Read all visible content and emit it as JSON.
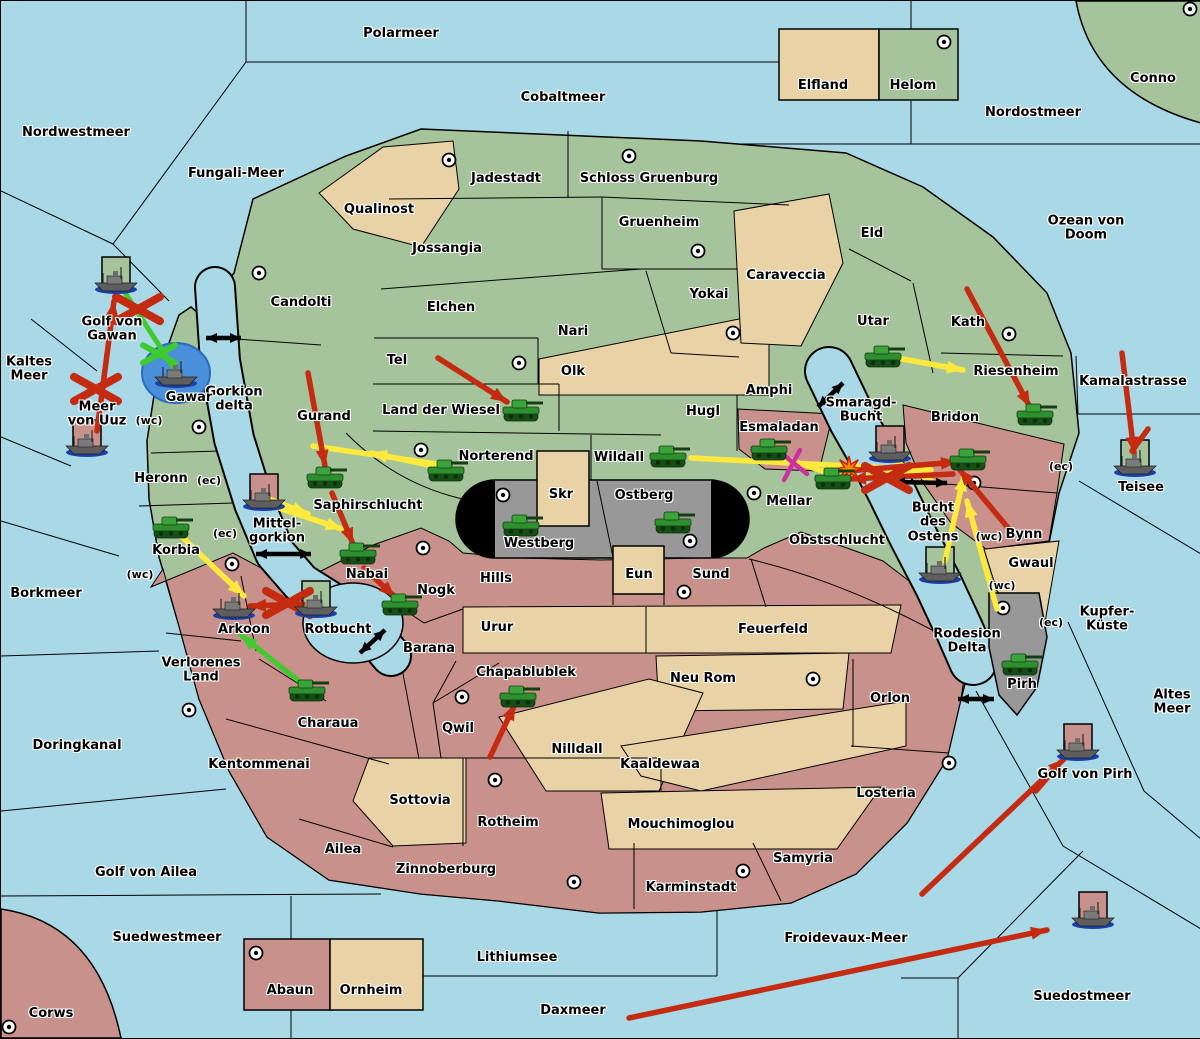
{
  "map": {
    "title": "Diplomacy variant strategy map",
    "width": 1200,
    "height": 1037,
    "colors": {
      "sea": "#A9D8E6",
      "land_green": "#A5C49B",
      "land_tan": "#E9D2A5",
      "land_pink": "#C9918B",
      "mountain_gray": "#989898",
      "tunnel_black": "#000000",
      "attack_red": "#C42B10",
      "support_yellow": "#FFE93C",
      "support_green": "#3ECB2E",
      "cut_magenta": "#CC2F9F",
      "strait_black": "#000000",
      "convoy_blue": "#4A8FD9",
      "unit_green": "#2E8F2E"
    },
    "sea_regions": [
      {
        "label": "Polarmeer",
        "x": 400,
        "y": 33
      },
      {
        "label": "Nordwestmeer",
        "x": 75,
        "y": 132
      },
      {
        "label": "Fungali-Meer",
        "x": 235,
        "y": 173
      },
      {
        "label": "Cobaltmeer",
        "x": 562,
        "y": 97
      },
      {
        "label": "Nordostmeer",
        "x": 1032,
        "y": 112
      },
      {
        "label": "Ozean von Doom",
        "x": 1085,
        "y": 228
      },
      {
        "label": "Kaltes\nMeer",
        "x": 28,
        "y": 369
      },
      {
        "label": "Golf von\nGawan",
        "x": 111,
        "y": 329
      },
      {
        "label": "Meer\nvon Uuz",
        "x": 96,
        "y": 414
      },
      {
        "label": "Gorkion\ndelta",
        "x": 233,
        "y": 399
      },
      {
        "label": "Mittel-\ngorkion",
        "x": 276,
        "y": 531
      },
      {
        "label": "Borkmeer",
        "x": 45,
        "y": 593
      },
      {
        "label": "Doringkanal",
        "x": 76,
        "y": 745
      },
      {
        "label": "Golf von Ailea",
        "x": 145,
        "y": 872
      },
      {
        "label": "Suedwestmeer",
        "x": 166,
        "y": 937
      },
      {
        "label": "Lithiumsee",
        "x": 516,
        "y": 957
      },
      {
        "label": "Daxmeer",
        "x": 572,
        "y": 1010
      },
      {
        "label": "Froidevaux-Meer",
        "x": 845,
        "y": 938
      },
      {
        "label": "Suedostmeer",
        "x": 1081,
        "y": 996
      },
      {
        "label": "Kamalastrasse",
        "x": 1132,
        "y": 381
      },
      {
        "label": "Teisee",
        "x": 1140,
        "y": 487
      },
      {
        "label": "Smaragd-\nBucht",
        "x": 860,
        "y": 410
      },
      {
        "label": "Bucht\ndes\nOstens",
        "x": 932,
        "y": 522
      },
      {
        "label": "Rotbucht",
        "x": 337,
        "y": 629
      },
      {
        "label": "Altes\nMeer",
        "x": 1171,
        "y": 702
      },
      {
        "label": "Kupfer-\nKüste",
        "x": 1106,
        "y": 619
      },
      {
        "label": "Golf von Pirh",
        "x": 1084,
        "y": 774
      },
      {
        "label": "Rodesion\nDelta",
        "x": 966,
        "y": 641
      }
    ],
    "land_regions": [
      {
        "label": "Conno",
        "x": 1152,
        "y": 78
      },
      {
        "label": "Corws",
        "x": 50,
        "y": 1013
      },
      {
        "label": "Elfland",
        "x": 822,
        "y": 85
      },
      {
        "label": "Helom",
        "x": 912,
        "y": 85
      },
      {
        "label": "Qualinost",
        "x": 378,
        "y": 209
      },
      {
        "label": "Jadestadt",
        "x": 505,
        "y": 178
      },
      {
        "label": "Schloss Gruenburg",
        "x": 648,
        "y": 178
      },
      {
        "label": "Gruenheim",
        "x": 658,
        "y": 222
      },
      {
        "label": "Jossangia",
        "x": 446,
        "y": 248
      },
      {
        "label": "Candolti",
        "x": 300,
        "y": 302
      },
      {
        "label": "Elchen",
        "x": 450,
        "y": 307
      },
      {
        "label": "Nari",
        "x": 572,
        "y": 331
      },
      {
        "label": "Olk",
        "x": 572,
        "y": 371
      },
      {
        "label": "Tel",
        "x": 396,
        "y": 360
      },
      {
        "label": "Land der Wiesel",
        "x": 440,
        "y": 410
      },
      {
        "label": "Gurand",
        "x": 323,
        "y": 416
      },
      {
        "label": "Norterend",
        "x": 495,
        "y": 456
      },
      {
        "label": "Saphirschlucht",
        "x": 367,
        "y": 505
      },
      {
        "label": "Yokai",
        "x": 708,
        "y": 294
      },
      {
        "label": "Caraveccia",
        "x": 785,
        "y": 275
      },
      {
        "label": "Eld",
        "x": 871,
        "y": 233
      },
      {
        "label": "Utar",
        "x": 872,
        "y": 321
      },
      {
        "label": "Kath",
        "x": 967,
        "y": 322
      },
      {
        "label": "Riesenheim",
        "x": 1015,
        "y": 371
      },
      {
        "label": "Hugl",
        "x": 702,
        "y": 411
      },
      {
        "label": "Amphi",
        "x": 768,
        "y": 390
      },
      {
        "label": "Esmaladan",
        "x": 778,
        "y": 427
      },
      {
        "label": "Wildall",
        "x": 618,
        "y": 457
      },
      {
        "label": "Mellar",
        "x": 788,
        "y": 501
      },
      {
        "label": "Obstschlucht",
        "x": 836,
        "y": 540
      },
      {
        "label": "Bridon",
        "x": 954,
        "y": 417
      },
      {
        "label": "Bynn",
        "x": 1023,
        "y": 534
      },
      {
        "label": "Gwaul",
        "x": 1030,
        "y": 563
      },
      {
        "label": "Pirh",
        "x": 1021,
        "y": 684
      },
      {
        "label": "Heronn",
        "x": 160,
        "y": 478
      },
      {
        "label": "Korbia",
        "x": 175,
        "y": 550
      },
      {
        "label": "Gawar",
        "x": 188,
        "y": 397
      },
      {
        "label": "Skr",
        "x": 560,
        "y": 494
      },
      {
        "label": "Ostberg",
        "x": 643,
        "y": 495
      },
      {
        "label": "Westberg",
        "x": 538,
        "y": 543
      },
      {
        "label": "Eun",
        "x": 638,
        "y": 574
      },
      {
        "label": "Hills",
        "x": 495,
        "y": 578
      },
      {
        "label": "Sund",
        "x": 710,
        "y": 574
      },
      {
        "label": "Urur",
        "x": 496,
        "y": 627
      },
      {
        "label": "Feuerfeld",
        "x": 772,
        "y": 629
      },
      {
        "label": "Barana",
        "x": 428,
        "y": 648
      },
      {
        "label": "Nogk",
        "x": 435,
        "y": 590
      },
      {
        "label": "Nabai",
        "x": 366,
        "y": 574
      },
      {
        "label": "Arkoon",
        "x": 243,
        "y": 629
      },
      {
        "label": "Verlorenes\nLand",
        "x": 200,
        "y": 670
      },
      {
        "label": "Charaua",
        "x": 327,
        "y": 723
      },
      {
        "label": "Kentommenai",
        "x": 258,
        "y": 764
      },
      {
        "label": "Chapablublek",
        "x": 525,
        "y": 672
      },
      {
        "label": "Qwil",
        "x": 457,
        "y": 728
      },
      {
        "label": "Nilldall",
        "x": 576,
        "y": 749
      },
      {
        "label": "Neu Rom",
        "x": 702,
        "y": 678
      },
      {
        "label": "Kaaldewaa",
        "x": 659,
        "y": 764
      },
      {
        "label": "Sottovia",
        "x": 419,
        "y": 800
      },
      {
        "label": "Rotheim",
        "x": 507,
        "y": 822
      },
      {
        "label": "Mouchimoglou",
        "x": 680,
        "y": 824
      },
      {
        "label": "Zinnoberburg",
        "x": 445,
        "y": 869
      },
      {
        "label": "Karminstadt",
        "x": 690,
        "y": 887
      },
      {
        "label": "Samyria",
        "x": 802,
        "y": 858
      },
      {
        "label": "Losteria",
        "x": 885,
        "y": 793
      },
      {
        "label": "Orlon",
        "x": 889,
        "y": 698
      },
      {
        "label": "Ailea",
        "x": 342,
        "y": 849
      },
      {
        "label": "Abaun",
        "x": 289,
        "y": 990
      },
      {
        "label": "Ornheim",
        "x": 370,
        "y": 990
      }
    ],
    "coast_labels": [
      {
        "text": "(wc)",
        "x": 148,
        "y": 420
      },
      {
        "text": "(ec)",
        "x": 208,
        "y": 480
      },
      {
        "text": "(ec)",
        "x": 224,
        "y": 533
      },
      {
        "text": "(wc)",
        "x": 139,
        "y": 574
      },
      {
        "text": "(wc)",
        "x": 988,
        "y": 536
      },
      {
        "text": "(ec)",
        "x": 1060,
        "y": 466
      },
      {
        "text": "(wc)",
        "x": 1001,
        "y": 585
      },
      {
        "text": "(ec)",
        "x": 1050,
        "y": 622
      }
    ],
    "supply_centers": [
      [
        258,
        272
      ],
      [
        448,
        159
      ],
      [
        628,
        155
      ],
      [
        697,
        250
      ],
      [
        732,
        332
      ],
      [
        943,
        41
      ],
      [
        1189,
        8
      ],
      [
        518,
        362
      ],
      [
        1008,
        333
      ],
      [
        420,
        449
      ],
      [
        198,
        426
      ],
      [
        231,
        563
      ],
      [
        188,
        709
      ],
      [
        422,
        547
      ],
      [
        502,
        494
      ],
      [
        689,
        540
      ],
      [
        753,
        492
      ],
      [
        683,
        591
      ],
      [
        461,
        696
      ],
      [
        494,
        779
      ],
      [
        573,
        881
      ],
      [
        742,
        870
      ],
      [
        812,
        678
      ],
      [
        948,
        762
      ],
      [
        973,
        482
      ],
      [
        1002,
        607
      ],
      [
        255,
        952
      ],
      [
        8,
        1026
      ]
    ],
    "units": {
      "armies": [
        {
          "region": "Land der Wiesel",
          "x": 520,
          "y": 410
        },
        {
          "region": "Norterend",
          "x": 445,
          "y": 470
        },
        {
          "region": "Saphirschlucht",
          "x": 324,
          "y": 477
        },
        {
          "region": "Nabai",
          "x": 357,
          "y": 553
        },
        {
          "region": "Nogk",
          "x": 399,
          "y": 604
        },
        {
          "region": "Charaua",
          "x": 306,
          "y": 690
        },
        {
          "region": "Korbia",
          "x": 170,
          "y": 527
        },
        {
          "region": "Chapablublek",
          "x": 517,
          "y": 696
        },
        {
          "region": "Westberg",
          "x": 520,
          "y": 525
        },
        {
          "region": "Ostberg",
          "x": 672,
          "y": 522
        },
        {
          "region": "Wildall",
          "x": 667,
          "y": 456
        },
        {
          "region": "Esmaladan",
          "x": 768,
          "y": 449
        },
        {
          "region": "Mellar",
          "x": 832,
          "y": 478
        },
        {
          "region": "Utar",
          "x": 882,
          "y": 356
        },
        {
          "region": "Riesenheim",
          "x": 1034,
          "y": 414
        },
        {
          "region": "Bridon",
          "x": 967,
          "y": 459
        },
        {
          "region": "Pirh",
          "x": 1019,
          "y": 664
        }
      ],
      "fleets": [
        {
          "region": "Golf von Gawan",
          "x": 115,
          "y": 280,
          "marker": "green-box"
        },
        {
          "region": "Meer von Uuz",
          "x": 86,
          "y": 443,
          "marker": "pink-box"
        },
        {
          "region": "Gawar",
          "x": 175,
          "y": 374,
          "marker": "blue-circle"
        },
        {
          "region": "Mittelgorkion",
          "x": 263,
          "y": 497,
          "marker": "pink-box"
        },
        {
          "region": "Arkoon",
          "x": 233,
          "y": 606,
          "marker": null
        },
        {
          "region": "Rotbucht",
          "x": 315,
          "y": 604,
          "marker": "green-box"
        },
        {
          "region": "Smaragd-Bucht",
          "x": 889,
          "y": 449,
          "marker": "pink-box"
        },
        {
          "region": "Bucht des Ostens",
          "x": 939,
          "y": 570,
          "marker": "green-box"
        },
        {
          "region": "Teisee",
          "x": 1134,
          "y": 463,
          "marker": "green-box"
        },
        {
          "region": "Golf von Pirh",
          "x": 1077,
          "y": 747,
          "marker": "pink-box"
        },
        {
          "region": "Suedostmeer",
          "x": 1092,
          "y": 915,
          "marker": "pink-box"
        }
      ]
    },
    "orders": {
      "attack_arrows_red": [
        {
          "from": [
            437,
            357
          ],
          "to": [
            506,
            401
          ]
        },
        {
          "from": [
            307,
            372
          ],
          "to": [
            324,
            465
          ]
        },
        {
          "from": [
            331,
            492
          ],
          "to": [
            352,
            543
          ]
        },
        {
          "from": [
            363,
            567
          ],
          "to": [
            394,
            596
          ]
        },
        {
          "from": [
            489,
            756
          ],
          "to": [
            514,
            703
          ]
        },
        {
          "from": [
            96,
            430
          ],
          "to": [
            113,
            300
          ]
        },
        {
          "from": [
            302,
            603
          ],
          "to": [
            249,
            605
          ]
        },
        {
          "from": [
            966,
            288
          ],
          "to": [
            1029,
            406
          ]
        },
        {
          "from": [
            1121,
            352
          ],
          "to": [
            1133,
            452
          ]
        },
        {
          "from": [
            1147,
            428
          ],
          "to": [
            1131,
            450
          ],
          "head": false
        },
        {
          "from": [
            846,
            470
          ],
          "to": [
            956,
            461
          ]
        },
        {
          "from": [
            952,
            473
          ],
          "to": [
            849,
            478
          ]
        },
        {
          "from": [
            1008,
            528
          ],
          "to": [
            958,
            468
          ]
        },
        {
          "from": [
            921,
            893
          ],
          "to": [
            1063,
            758
          ]
        },
        {
          "from": [
            1035,
            790
          ],
          "to": [
            1052,
            770
          ],
          "head": false
        },
        {
          "from": [
            628,
            1017
          ],
          "to": [
            1046,
            929
          ]
        }
      ],
      "support_arrows_yellow": [
        {
          "from": [
            180,
            535
          ],
          "to": [
            243,
            595
          ]
        },
        {
          "from": [
            268,
            498
          ],
          "to": [
            307,
            513
          ]
        },
        {
          "from": [
            272,
            505
          ],
          "to": [
            341,
            528
          ]
        },
        {
          "from": [
            438,
            466
          ],
          "to": [
            370,
            452
          ]
        },
        {
          "from": [
            312,
            445
          ],
          "to": [
            436,
            463
          ],
          "head": false
        },
        {
          "from": [
            896,
            357
          ],
          "to": [
            962,
            369
          ]
        },
        {
          "from": [
            690,
            457
          ],
          "to": [
            930,
            469
          ]
        },
        {
          "from": [
            768,
            452
          ],
          "to": [
            842,
            477
          ],
          "head": false
        },
        {
          "from": [
            944,
            560
          ],
          "to": [
            963,
            474
          ]
        },
        {
          "from": [
            996,
            608
          ],
          "to": [
            966,
            500
          ]
        },
        {
          "from": [
            890,
            458
          ],
          "to": [
            932,
            481
          ],
          "head": false
        },
        {
          "from": [
            848,
            478
          ],
          "to": [
            908,
            470
          ],
          "head": false
        }
      ],
      "support_lines_green": [
        {
          "from": [
            172,
            366
          ],
          "to": [
            121,
            287
          ],
          "head": false
        },
        {
          "from": [
            303,
            684
          ],
          "to": [
            240,
            634
          ]
        }
      ],
      "cut_lines_magenta": [
        {
          "from": [
            779,
            451
          ],
          "to": [
            806,
            473
          ],
          "head": false
        },
        {
          "from": [
            799,
            449
          ],
          "to": [
            783,
            479
          ],
          "head": false
        }
      ],
      "strait_arrows_black": [
        {
          "from": [
            205,
            337
          ],
          "to": [
            240,
            337
          ]
        },
        {
          "from": [
            255,
            553
          ],
          "to": [
            310,
            553
          ]
        },
        {
          "from": [
            817,
            406
          ],
          "to": [
            842,
            382
          ]
        },
        {
          "from": [
            359,
            652
          ],
          "to": [
            384,
            629
          ]
        },
        {
          "from": [
            893,
            481
          ],
          "to": [
            946,
            482
          ]
        },
        {
          "from": [
            957,
            698
          ],
          "to": [
            993,
            698
          ]
        }
      ],
      "failed_x_red": [
        [
          95,
          388
        ],
        [
          137,
          308
        ],
        [
          287,
          602
        ],
        [
          886,
          477
        ]
      ],
      "cut_x_green": [
        [
          158,
          353
        ]
      ],
      "conflict_star": [
        [
          848,
          468
        ]
      ]
    }
  }
}
